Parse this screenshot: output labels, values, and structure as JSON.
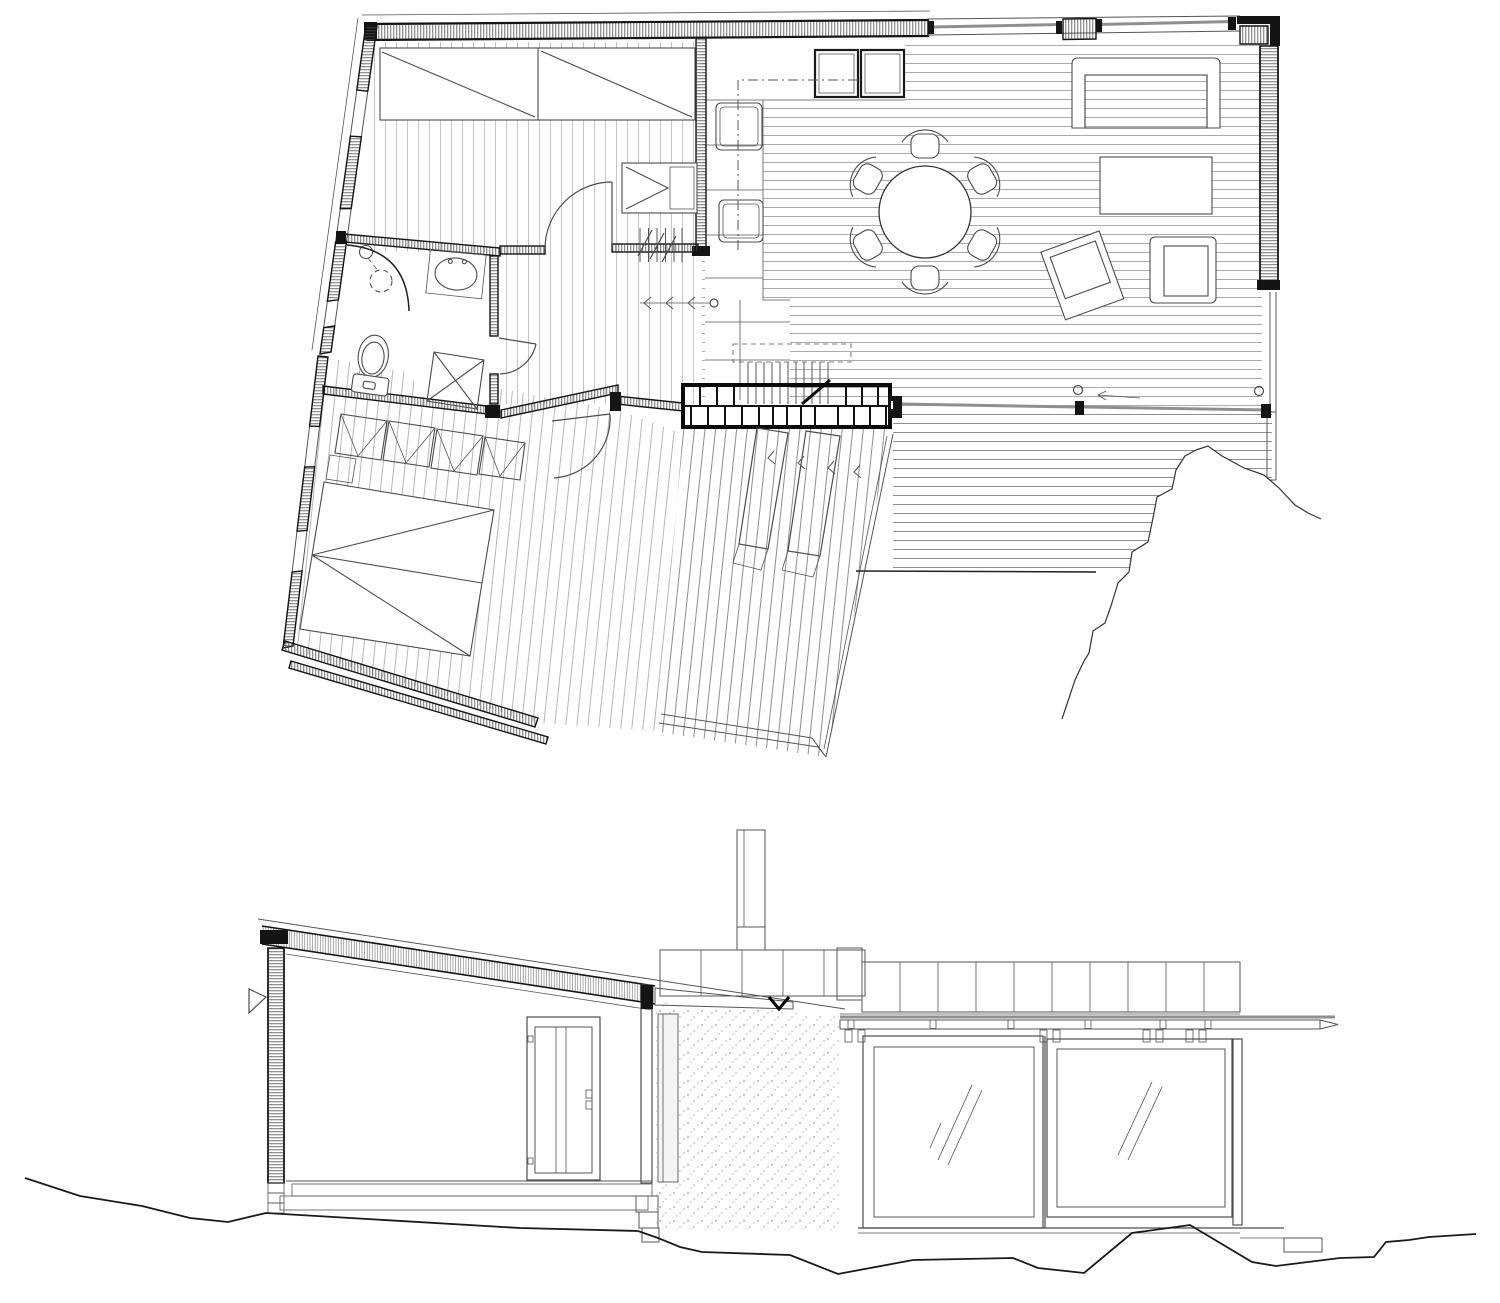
{
  "meta": {
    "drawing_type": "architectural line drawing",
    "views": [
      "floor plan",
      "cross section"
    ],
    "has_text": false
  },
  "palette": {
    "paper": "#ffffff",
    "ink": "#141414",
    "line": "#555555",
    "furniture": "#4c4c4c",
    "glass": "#8f8f8f",
    "ground": "#1a1a1a"
  },
  "plan": {
    "rooms": [
      "bedroom-upper",
      "bathroom",
      "hall",
      "kitchen",
      "living-dining",
      "bedroom-lower",
      "deck-lower",
      "deck-east"
    ],
    "furniture_symbols": [
      "double-bed",
      "closet",
      "loft-ladder",
      "shower",
      "sink",
      "toilet",
      "washer",
      "kitchen-counter",
      "cooktop-modules",
      "dining-table",
      "dining-chair",
      "sofa",
      "coffee-table",
      "armchair",
      "lounge-chair",
      "masonry-fireplace",
      "loft-stair",
      "wardrobe-row",
      "deck-steps"
    ],
    "dining_chair_count": 6,
    "door_swing_count": 4,
    "handle_circle_count": 5,
    "rock_outcrop": true
  },
  "section": {
    "elements": [
      "mono-pitch-roof",
      "clad-wall",
      "interior-door",
      "chimney",
      "concrete-core",
      "clerestory-band",
      "glazed-sliding-panels",
      "foundation-steps",
      "ground-profile"
    ],
    "glazing_panel_count": 2,
    "clerestory_square_count": 14
  }
}
